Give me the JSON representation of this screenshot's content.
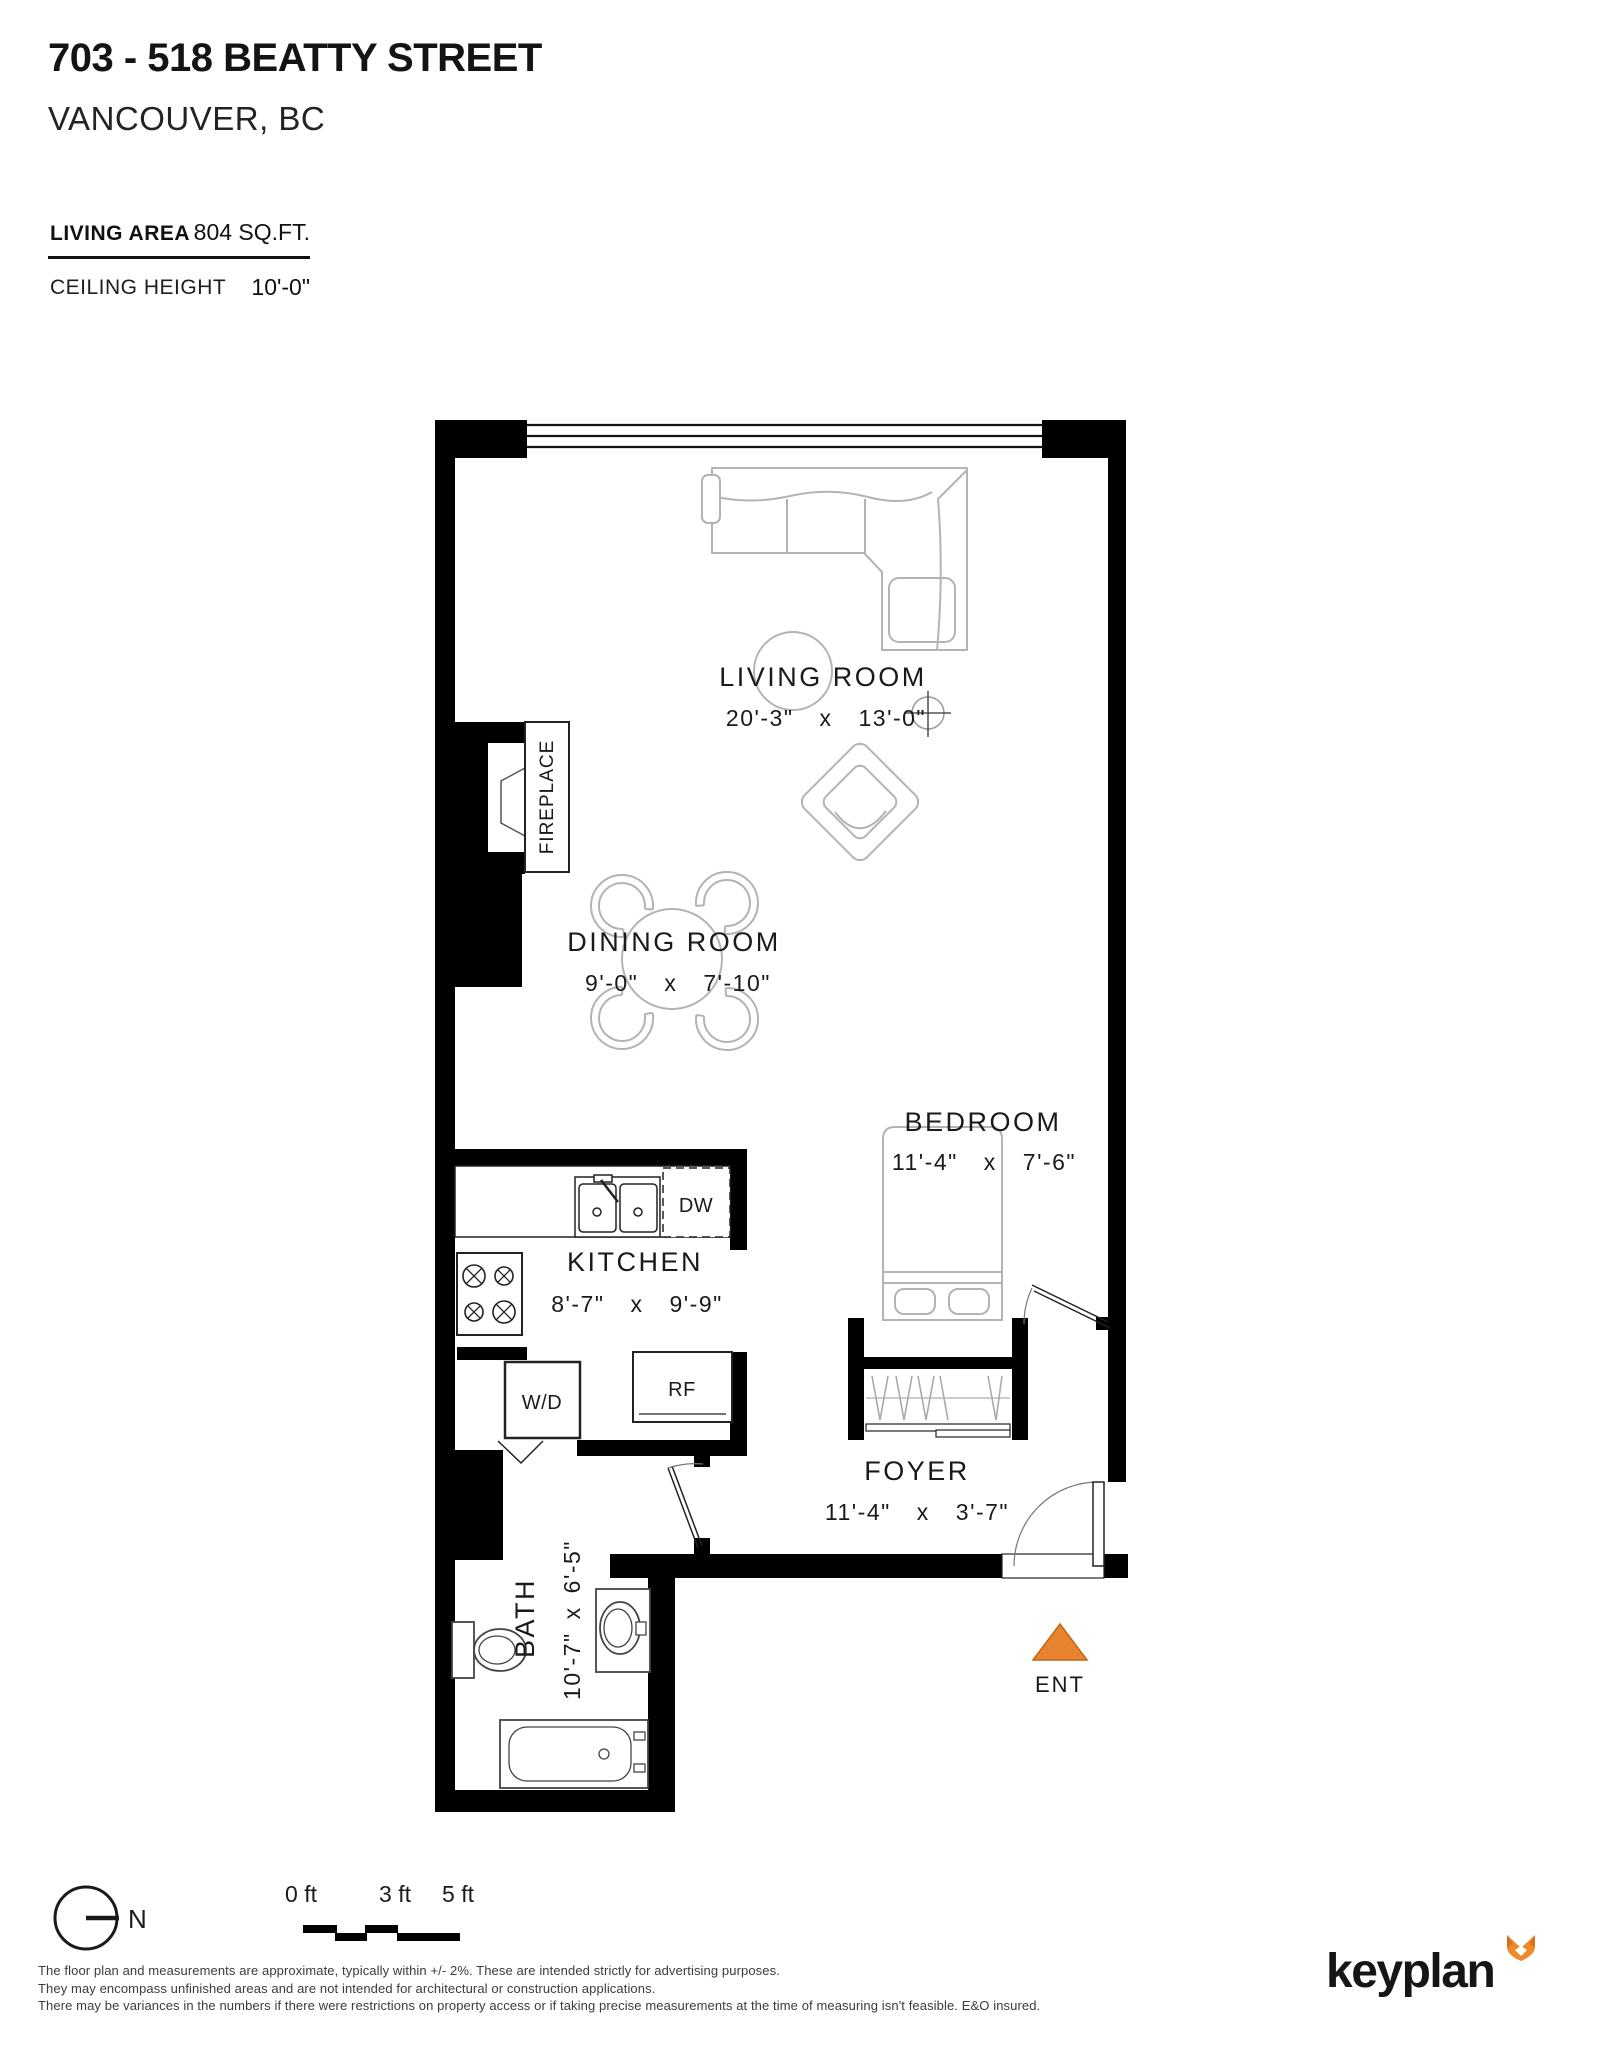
{
  "header": {
    "title": "703 - 518 BEATTY STREET",
    "city": "VANCOUVER, BC",
    "living_area_label": "LIVING AREA",
    "living_area_value": "804 SQ.FT.",
    "ceiling_label": "CEILING HEIGHT",
    "ceiling_value": "10'-0\""
  },
  "rooms": {
    "living": {
      "name": "LIVING ROOM",
      "dims": "20'-3\"  x  13'-0\""
    },
    "dining": {
      "name": "DINING ROOM",
      "dims": "9'-0\"  x  7'-10\""
    },
    "kitchen": {
      "name": "KITCHEN",
      "dims": "8'-7\"  x  9'-9\""
    },
    "bedroom": {
      "name": "BEDROOM",
      "dims": "11'-4\"  x  7'-6\""
    },
    "foyer": {
      "name": "FOYER",
      "dims": "11'-4\"  x  3'-7\""
    },
    "bath": {
      "name": "BATH",
      "dims": "10'-7\" x 6'-5\""
    }
  },
  "fixtures": {
    "fireplace": "FIREPLACE",
    "dishwasher": "DW",
    "washer_dryer": "W/D",
    "refrigerator": "RF",
    "entry": "ENT"
  },
  "compass": {
    "north": "N"
  },
  "scale_bar": {
    "labels": [
      "0 ft",
      "3 ft",
      "5 ft"
    ]
  },
  "disclaimer": {
    "line1": "The floor plan and measurements are approximate, typically within +/- 2%. These are intended strictly for advertising purposes.",
    "line2": "They may encompass unfinished areas and are not intended for architectural or construction applications.",
    "line3": "There may be variances in the numbers if there were restrictions on property access or if taking precise measurements at the time of measuring isn't feasible. E&O insured."
  },
  "logo": {
    "text": "keyplan"
  },
  "colors": {
    "accent_orange": "#E8842F",
    "wall_black": "#000000"
  }
}
